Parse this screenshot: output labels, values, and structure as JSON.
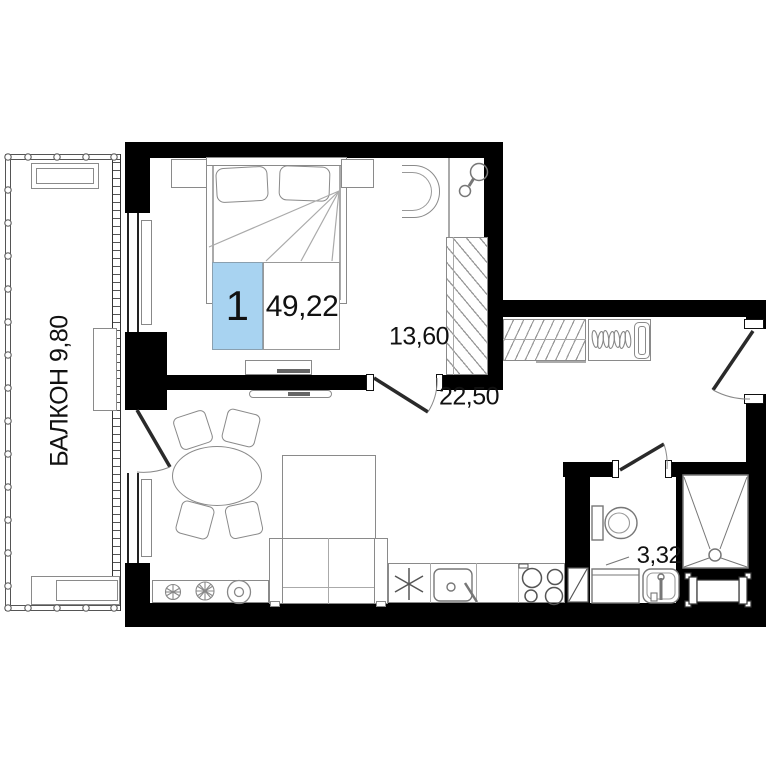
{
  "labels": {
    "balcony": "БАЛКОН 9,80",
    "unit_number": "1",
    "total_area": "49,22",
    "bedroom_area": "13,60",
    "kitchen_living_area": "22,50",
    "bathroom_area": "3,32"
  },
  "colors": {
    "wall": "#000000",
    "furniture_line": "#8a8a8a",
    "badge_fill": "#a8d3f1",
    "text": "#111111"
  }
}
